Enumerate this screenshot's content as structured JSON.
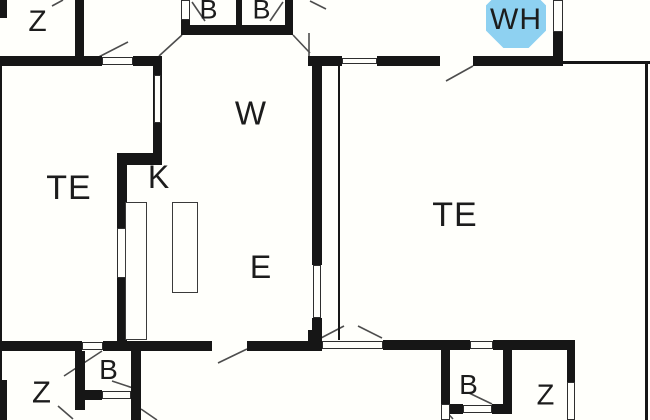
{
  "colors": {
    "background": "#fffffb",
    "wall": "#161616",
    "window_outline": "#2e2e2e",
    "swing_line": "#4d4d4d",
    "label": "#1c1c1c",
    "octagon_fill": "#8ED1F1"
  },
  "octagon": {
    "cx": 516,
    "cy": 18,
    "size": 60
  },
  "labels": [
    {
      "id": "z-top",
      "text": "Z",
      "x": 38,
      "y": 22,
      "size": 30
    },
    {
      "id": "b-top-left",
      "text": "B",
      "x": 209,
      "y": 10,
      "size": 27
    },
    {
      "id": "b-top-right",
      "text": "B",
      "x": 262,
      "y": 10,
      "size": 27
    },
    {
      "id": "wh",
      "text": "WH",
      "x": 516,
      "y": 20,
      "size": 30
    },
    {
      "id": "w-hall",
      "text": "W",
      "x": 251,
      "y": 113,
      "size": 33
    },
    {
      "id": "te-left",
      "text": "TE",
      "x": 69,
      "y": 188,
      "size": 34
    },
    {
      "id": "k-kitchen",
      "text": "K",
      "x": 159,
      "y": 177,
      "size": 32
    },
    {
      "id": "e-hall",
      "text": "E",
      "x": 261,
      "y": 267,
      "size": 32
    },
    {
      "id": "te-right",
      "text": "TE",
      "x": 455,
      "y": 215,
      "size": 34
    },
    {
      "id": "z-bottom-left",
      "text": "Z",
      "x": 42,
      "y": 392,
      "size": 31
    },
    {
      "id": "b-bottom-left",
      "text": "B",
      "x": 109,
      "y": 370,
      "size": 28
    },
    {
      "id": "b-bottom-right",
      "text": "B",
      "x": 469,
      "y": 385,
      "size": 28
    },
    {
      "id": "z-bottom-right",
      "text": "Z",
      "x": 546,
      "y": 396,
      "size": 29
    }
  ],
  "walls": [
    [
      0,
      56,
      102,
      10
    ],
    [
      133,
      56,
      29,
      10
    ],
    [
      308,
      56,
      34,
      10
    ],
    [
      377,
      56,
      63,
      10
    ],
    [
      473,
      56,
      90,
      10
    ],
    [
      563,
      61,
      87,
      3
    ],
    [
      181,
      25,
      112,
      10
    ],
    [
      0,
      341,
      82,
      10
    ],
    [
      103,
      341,
      109,
      10
    ],
    [
      247,
      341,
      63,
      10
    ],
    [
      383,
      340,
      87,
      10
    ],
    [
      493,
      340,
      82,
      10
    ],
    [
      308,
      330,
      14,
      21
    ],
    [
      117,
      153,
      45,
      12
    ],
    [
      0,
      0,
      7,
      18
    ],
    [
      75,
      0,
      9,
      56
    ],
    [
      153,
      66,
      9,
      87
    ],
    [
      117,
      165,
      10,
      176
    ],
    [
      181,
      18,
      9,
      8
    ],
    [
      236,
      0,
      6,
      25
    ],
    [
      285,
      0,
      8,
      35
    ],
    [
      312,
      56,
      10,
      209
    ],
    [
      312,
      318,
      10,
      23
    ],
    [
      553,
      32,
      10,
      34
    ],
    [
      567,
      350,
      8,
      33
    ],
    [
      75,
      351,
      10,
      59
    ],
    [
      131,
      351,
      10,
      69
    ],
    [
      441,
      350,
      9,
      54
    ],
    [
      503,
      350,
      9,
      61
    ],
    [
      85,
      390,
      17,
      10
    ],
    [
      450,
      404,
      13,
      10
    ],
    [
      492,
      404,
      20,
      10
    ],
    [
      0,
      66,
      2,
      314
    ],
    [
      0,
      380,
      7,
      40
    ],
    [
      338,
      66,
      2,
      274
    ],
    [
      645,
      62,
      3,
      358
    ]
  ],
  "windows": [
    [
      102,
      57,
      31,
      8
    ],
    [
      342,
      58,
      35,
      6
    ],
    [
      154,
      75,
      7,
      48
    ],
    [
      117,
      228,
      9,
      50
    ],
    [
      313,
      265,
      8,
      53
    ],
    [
      553,
      0,
      10,
      32
    ],
    [
      82,
      342,
      21,
      8
    ],
    [
      322,
      341,
      61,
      8
    ],
    [
      470,
      341,
      23,
      8
    ],
    [
      567,
      382,
      8,
      38
    ],
    [
      181,
      0,
      9,
      20
    ],
    [
      102,
      391,
      29,
      8
    ],
    [
      463,
      405,
      29,
      8
    ],
    [
      441,
      404,
      9,
      16
    ]
  ],
  "counters": [
    [
      125,
      202,
      22,
      138
    ],
    [
      172,
      202,
      26,
      91
    ]
  ],
  "swings": [
    [
      85,
      64,
      128,
      42
    ],
    [
      182,
      35,
      159,
      56
    ],
    [
      293,
      35,
      310,
      53
    ],
    [
      309,
      33,
      309,
      56
    ],
    [
      310,
      1,
      326,
      9
    ],
    [
      473,
      66,
      446,
      81
    ],
    [
      321,
      338,
      344,
      326
    ],
    [
      382,
      338,
      358,
      326
    ],
    [
      247,
      349,
      218,
      363
    ],
    [
      102,
      351,
      64,
      376
    ],
    [
      112,
      381,
      139,
      390
    ],
    [
      58,
      406,
      73,
      419
    ],
    [
      141,
      409,
      157,
      420
    ],
    [
      469,
      393,
      492,
      404
    ],
    [
      442,
      407,
      453,
      419
    ],
    [
      192,
      2,
      205,
      21
    ],
    [
      283,
      2,
      270,
      21
    ],
    [
      52,
      6,
      63,
      0
    ]
  ]
}
